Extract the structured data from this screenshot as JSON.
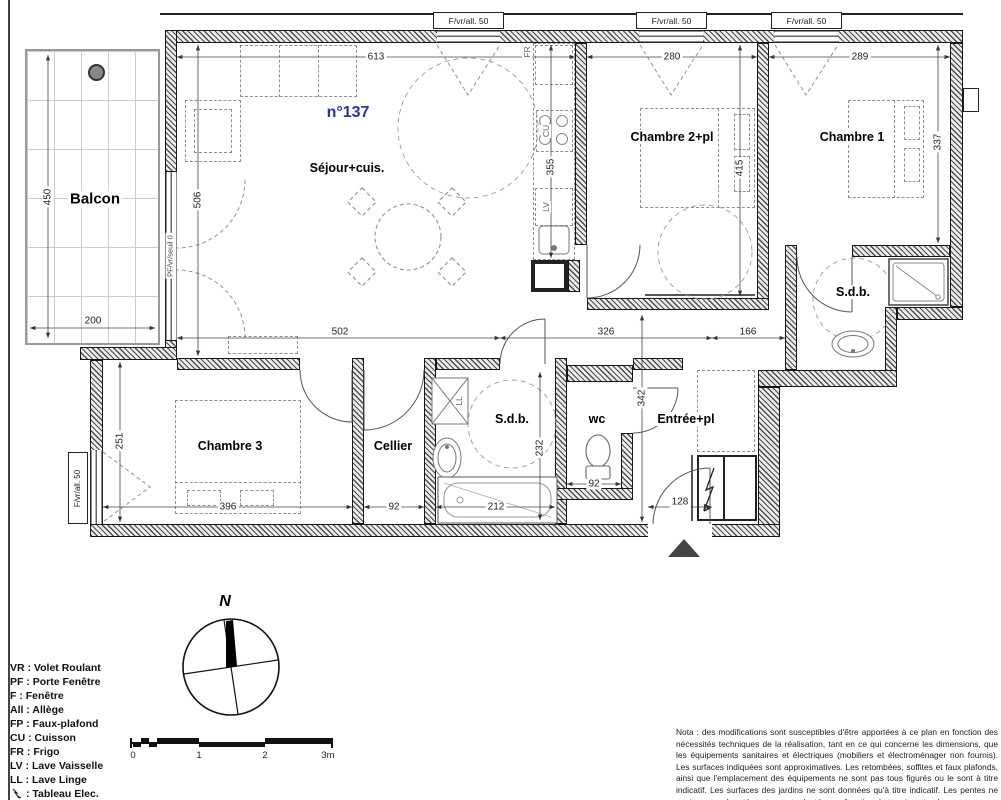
{
  "title": {
    "unit": "n°137"
  },
  "rooms": {
    "balcon": "Balcon",
    "sejour": "Séjour+cuis.",
    "chambre2": "Chambre 2+pl",
    "chambre1": "Chambre 1",
    "sdb1": "S.d.b.",
    "chambre3": "Chambre 3",
    "cellier": "Cellier",
    "sdb2": "S.d.b.",
    "wc": "wc",
    "entree": "Entrée+pl"
  },
  "windows": {
    "top1": "F/vr/all. 50",
    "top2": "F/vr/all. 50",
    "top3": "F/vr/all. 50",
    "left": "F/vr/all. 50",
    "balcony": "PF/vr/seuil 0"
  },
  "kitchen": {
    "fr": "FR",
    "cu": "CU",
    "lv": "LV"
  },
  "laundry": {
    "ll": "LL"
  },
  "dims": {
    "sejour_w": "613",
    "ch2_w": "280",
    "ch1_w": "289",
    "sejour_h": "506",
    "kitchen_h": "355",
    "ch2_h": "415",
    "ch1_h": "337",
    "balcon_h": "450",
    "balcon_w": "200",
    "sejour_low": "502",
    "hall_w": "326",
    "hall_r": "166",
    "ch3_h": "251",
    "ch3_w": "396",
    "cellier_w": "92",
    "bath_w": "212",
    "sdb2_h": "232",
    "wc_w": "92",
    "entree_h": "342",
    "entree_door": "128"
  },
  "compass": {
    "north": "N"
  },
  "scalebar": {
    "t0": "0",
    "t1": "1",
    "t2": "2",
    "t3": "3m"
  },
  "legend": {
    "items": [
      "VR : Volet Roulant",
      "PF : Porte Fenêtre",
      "F : Fenêtre",
      "All : Allège",
      "FP : Faux-plafond",
      "CU : Cuisson",
      "FR : Frigo",
      "LV : Lave Vaisselle",
      "LL : Lave Linge"
    ],
    "tableau": ": Tableau Elec."
  },
  "note": {
    "text": "Nota : des modifications sont susceptibles d'être apportées à ce plan en fonction des nécessités techniques de la réalisation, tant en ce qui concerne les dimensions, que les équipements sanitaires et électriques (mobiliers et électroménager non fournis). Les surfaces indiquées sont approximatives. Les retombées, soffites et faux plafonds, ainsi que l'emplacement des équipements ne sont pas tous figurés ou le sont à titre indicatif. Les surfaces des jardins ne sont données qu'à titre indicatif. Les pentes ne sont pas représentées et seront adaptées en fonction du terrain naturel."
  }
}
